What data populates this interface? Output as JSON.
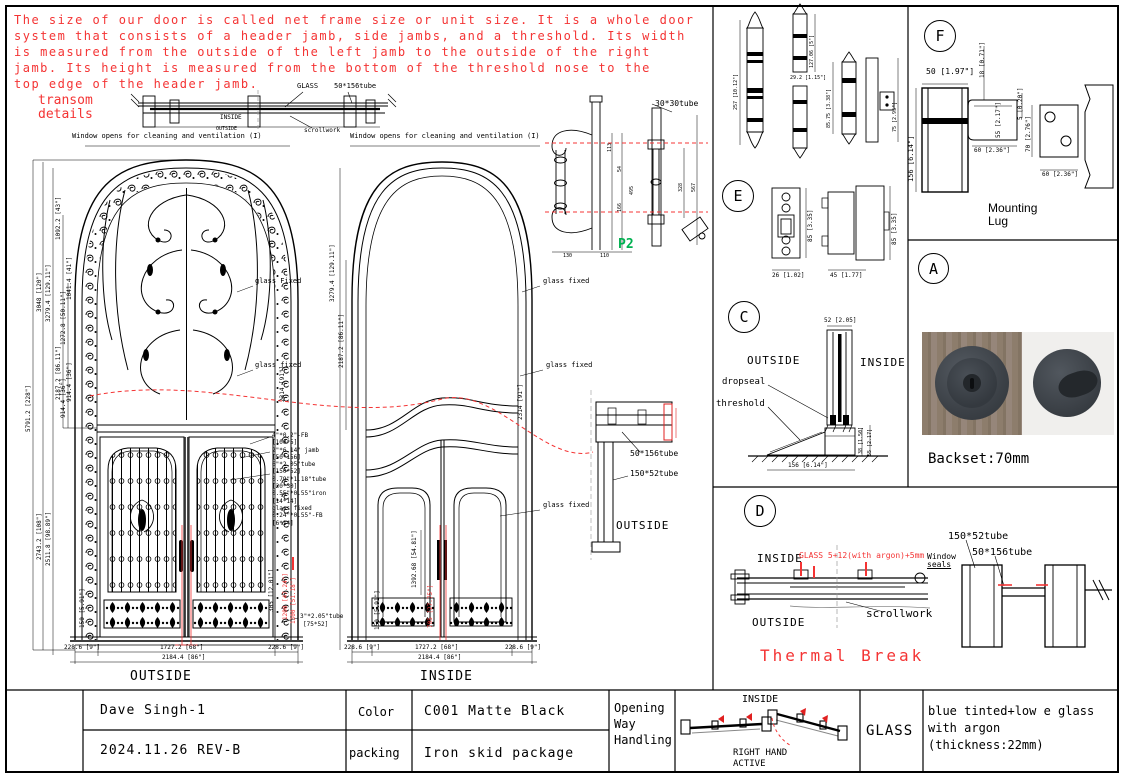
{
  "colors": {
    "annotation_red": "#f43434",
    "page_green": "#00b050",
    "line_black": "#000000"
  },
  "note": {
    "l1": "The size of our door is called net frame size or unit size. It is a whole door",
    "l2": "system that consists of a header jamb, side jambs, and a threshold. Its width",
    "l3": "is measured from the outside of the left jamb to the outside of the right",
    "l4": "jamb. Its height is measured from the bottom of the threshold nose to the",
    "l5": "top edge of the header jamb."
  },
  "tr": {
    "t1": "transom",
    "t2": "details",
    "glass": "GLASS",
    "tube": "50*156tube",
    "inside": "INSIDE",
    "outside": "OUTSIDE",
    "scroll": "scrollwork",
    "win_l": "Window opens for cleaning and ventilation (I)",
    "win_r": "Window opens for cleaning and ventilation (I)"
  },
  "ld": {
    "d1": "5791.2 [228\"]",
    "d2": "3048 [120\"]",
    "d3": "3279.4 [129.11\"]",
    "d4": "1092.2 [43\"]",
    "d5": "1041.4 [41\"]",
    "d6": "1272.8 [50.11\"]",
    "d7": "2187.2 [86.11\"]",
    "d8": "914.4 [36\"]",
    "d9": "914.4 [36\"]",
    "d10": "2743.2 [108\"]",
    "d11": "2511.8 [98.89\"]",
    "d12": "2314 [91\"]",
    "d13": "150 [5.91\"]",
    "d14": "305 [12.01\"]",
    "r1": "1200 [47.24\"]",
    "r2": "1300 [51.18\"]",
    "b1": "228.6 [9\"]",
    "b2": "1727.2 [68\"]",
    "b3": "228.6 [9\"]",
    "b4": "2184.4 [86\"]",
    "label": "OUTSIDE",
    "gf": "glass fixed",
    "gf2": "glass Fixed",
    "co": [
      "4\"*0.2\"-FB",
      "[100*5]",
      "2\"*6.14\" jamb",
      "[50*156]",
      "6\"*2.05\"tube",
      "[150*52]",
      "0.79\"*1.18\"tube",
      "[20*30]",
      "0.55\"*0.55\"iron",
      "[14*14]",
      "glass fixed",
      "0.24\"*0.55\"-FB",
      "[6*14]"
    ],
    "co2": "3\"*2.05\"tube",
    "co3": "[75*52]"
  },
  "rd": {
    "d2": "3279.4 [129.11\"]",
    "d3": "2187.2 [86.11\"]",
    "d4": "2314 [91\"]",
    "d5": "1392.68 [54.81\"]",
    "d6": "150 [5.91\"]",
    "r1": "705 [27.75\"]",
    "b1": "228.6 [9\"]",
    "b2": "1727.2 [68\"]",
    "b3": "228.6 [9\"]",
    "b4": "2184.4 [86\"]",
    "label": "INSIDE",
    "gf": "glass fixed"
  },
  "hd": {
    "tube": "30*30tube",
    "page": "P2",
    "d1": "113",
    "d2": "54",
    "d3": "166",
    "d4": "495",
    "d5": "130",
    "d6": "110",
    "d7": "328",
    "d8": "567"
  },
  "jd": {
    "t1": "50*156tube",
    "t2": "150*52tube",
    "label": "OUTSIDE"
  },
  "hg": {
    "d1": "257 [10.12\"]",
    "d2": "127.06 [5\"]",
    "d3": "29.2 [1.15\"]",
    "d4": "85.75 [3.38\"]",
    "d5": "75 [2.95\"]"
  },
  "pe": {
    "letter": "E",
    "d1": "85 [3.35]",
    "d2": "85 [3.35]",
    "d3": "26 [1.02]",
    "d4": "45 [1.77]"
  },
  "pc": {
    "letter": "C",
    "outside": "OUTSIDE",
    "inside": "INSIDE",
    "dropseal": "dropseal",
    "threshold": "threshold",
    "d1": "52 [2.05]",
    "d2": "156 [6.14\"]",
    "d3": "38 [1.50]",
    "d4": "55 [2.17]"
  },
  "pf": {
    "letter": "F",
    "cap1": "Mounting",
    "cap2": "Lug",
    "d1": "50 [1.97\"]",
    "d2": "18 [0.71\"]",
    "d3": "156 [6.14\"]",
    "d4": "55 [2.17\"]",
    "d5": "5 [0.20\"]",
    "d6": "60 [2.36\"]",
    "d7": "70 [2.76\"]",
    "d8": "60 [2.36\"]"
  },
  "pa": {
    "letter": "A",
    "caption": "Backset:70mm"
  },
  "pd": {
    "letter": "D",
    "inside": "INSIDE",
    "outside": "OUTSIDE",
    "glass_note": "GLASS 5+12(with argon)+5mm",
    "ws1": "Window",
    "ws2": "seals",
    "scroll": "scrollwork",
    "t1": "150*52tube",
    "t2": "50*156tube",
    "title": "Thermal Break"
  },
  "tb": {
    "name": "Dave Singh-1",
    "rev": "2024.11.26 REV-B",
    "color_l": "Color",
    "color_v": "C001 Matte Black",
    "pack_l": "packing",
    "pack_v": "Iron skid package",
    "open1": "Opening",
    "open2": "Way",
    "open3": "Handling",
    "inside": "INSIDE",
    "hand1": "RIGHT HAND",
    "hand2": "ACTIVE",
    "glass_l": "GLASS",
    "g1": "blue tinted+low e glass",
    "g2": "with argon",
    "g3": "(thickness:22mm)"
  }
}
